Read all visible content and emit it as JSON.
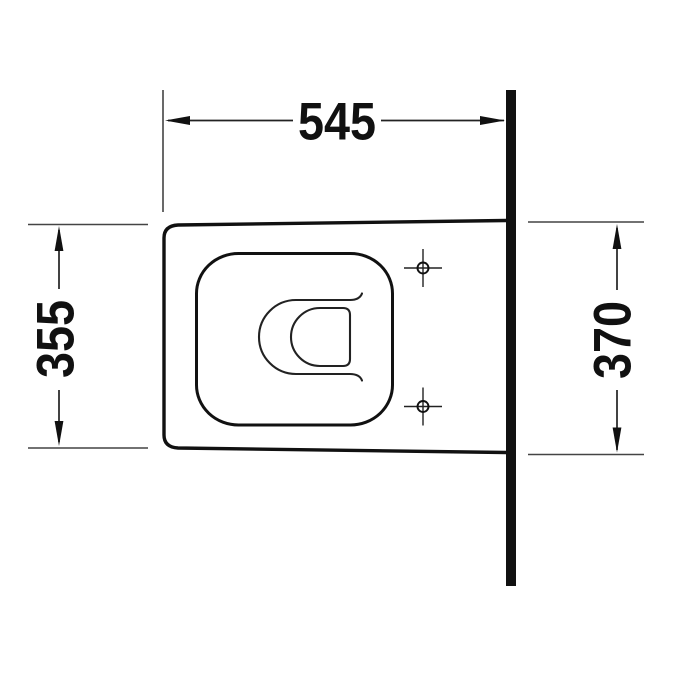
{
  "drawing": {
    "type": "technical-dimension-drawing",
    "subject": "wall-mounted toilet, top view",
    "colors": {
      "ink": "#111111",
      "thin_line": "#444444",
      "background": "#ffffff"
    },
    "dimensions": {
      "overall_depth": {
        "label": "545",
        "orientation": "horizontal",
        "position": "top"
      },
      "front_width": {
        "label": "355",
        "orientation": "vertical",
        "position": "left"
      },
      "rear_width": {
        "label": "370",
        "orientation": "vertical",
        "position": "right"
      }
    },
    "parts": {
      "wall": "wall section line",
      "body": "toilet body outline",
      "seat": "seat outline",
      "bowl": "inner bowl contour",
      "mounting_holes": 2
    }
  }
}
